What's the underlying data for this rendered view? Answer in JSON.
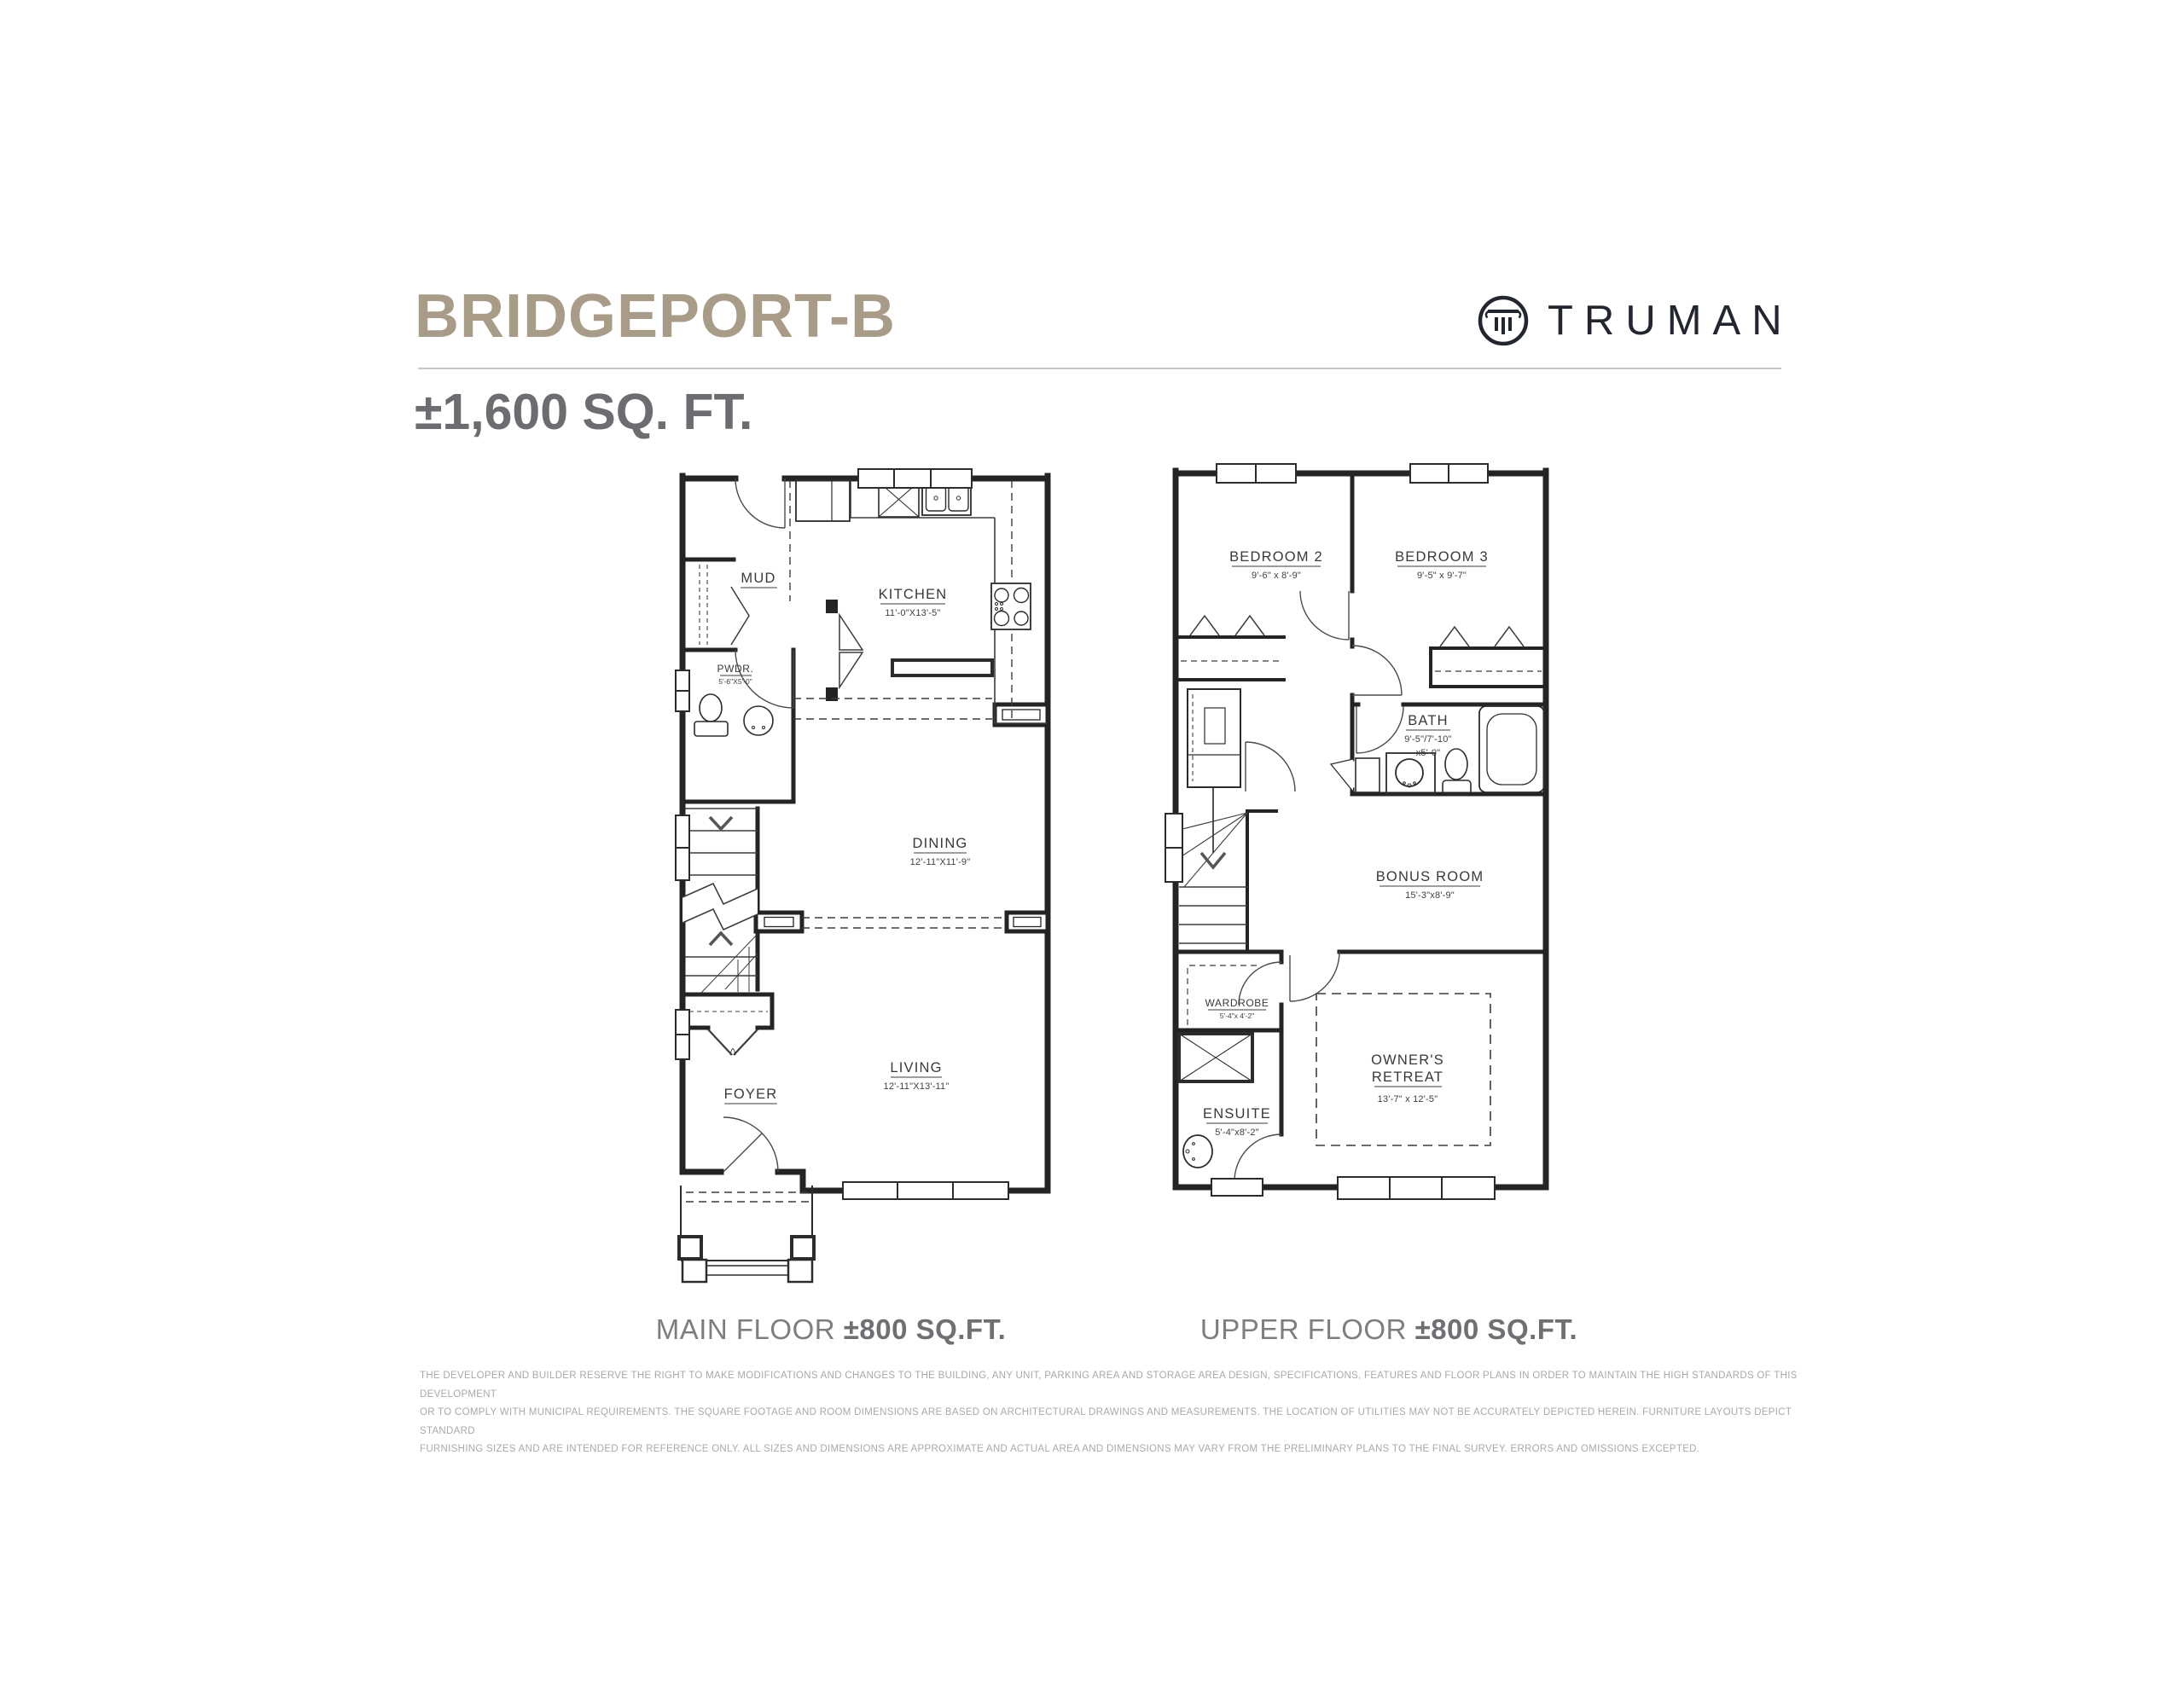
{
  "header": {
    "plan_name": "BRIDGEPORT-B",
    "total_area": "±1,600 SQ. FT.",
    "brand": "TRUMAN"
  },
  "main_floor": {
    "caption": {
      "label": "MAIN FLOOR",
      "area": "±800 SQ.FT."
    },
    "rooms": {
      "mud": {
        "name": "MUD"
      },
      "pwdr": {
        "name": "PWDR.",
        "dims": "5'-6\"X5'-0\""
      },
      "kitchen": {
        "name": "KITCHEN",
        "dims": "11'-0\"X13'-5\""
      },
      "dining": {
        "name": "DINING",
        "dims": "12'-11\"X11'-9\""
      },
      "living": {
        "name": "LIVING",
        "dims": "12'-11\"X13'-11\""
      },
      "foyer": {
        "name": "FOYER"
      }
    }
  },
  "upper_floor": {
    "caption": {
      "label": "UPPER FLOOR",
      "area": "±800 SQ.FT."
    },
    "rooms": {
      "bedroom2": {
        "name": "BEDROOM 2",
        "dims": "9'-6\" x 8'-9\""
      },
      "bedroom3": {
        "name": "BEDROOM 3",
        "dims": "9'-5\" x 9'-7\""
      },
      "bath": {
        "name": "BATH",
        "dims_line1": "9'-5\"/7'-10\"",
        "dims_line2": "x5'-0\""
      },
      "bonus": {
        "name": "BONUS ROOM",
        "dims": "15'-3\"x8'-9\""
      },
      "wardrobe": {
        "name": "WARDROBE",
        "dims": "5'-4\"x 4'-2\""
      },
      "owners": {
        "name_line1": "OWNER'S",
        "name_line2": "RETREAT",
        "dims": "13'-7\" x 12'-5\""
      },
      "ensuite": {
        "name": "ENSUITE",
        "dims": "5'-4\"x8'-2\""
      }
    }
  },
  "disclaimer": {
    "line1": "THE DEVELOPER AND BUILDER RESERVE THE RIGHT TO MAKE MODIFICATIONS AND CHANGES TO THE BUILDING, ANY UNIT, PARKING AREA AND STORAGE AREA DESIGN, SPECIFICATIONS, FEATURES AND FLOOR PLANS IN ORDER TO MAINTAIN THE HIGH STANDARDS OF THIS DEVELOPMENT",
    "line2": "OR TO COMPLY WITH MUNICIPAL REQUIREMENTS. THE SQUARE FOOTAGE AND ROOM DIMENSIONS ARE BASED ON ARCHITECTURAL DRAWINGS AND MEASUREMENTS. THE LOCATION OF UTILITIES MAY NOT BE ACCURATELY DEPICTED HEREIN. FURNITURE LAYOUTS DEPICT STANDARD",
    "line3": "FURNISHING SIZES AND ARE INTENDED FOR REFERENCE ONLY. ALL SIZES AND DIMENSIONS ARE APPROXIMATE AND ACTUAL AREA AND DIMENSIONS MAY VARY FROM THE PRELIMINARY PLANS TO THE FINAL SURVEY. ERRORS AND OMISSIONS EXCEPTED."
  },
  "colors": {
    "accent_taupe": "#a89c88",
    "subtitle_gray": "#6c6d70",
    "brand_navy": "#22262e",
    "caption_gray": "#7d7e81",
    "disclaimer_gray": "#a8a9ab",
    "plan_line": "#2c2c2c"
  }
}
